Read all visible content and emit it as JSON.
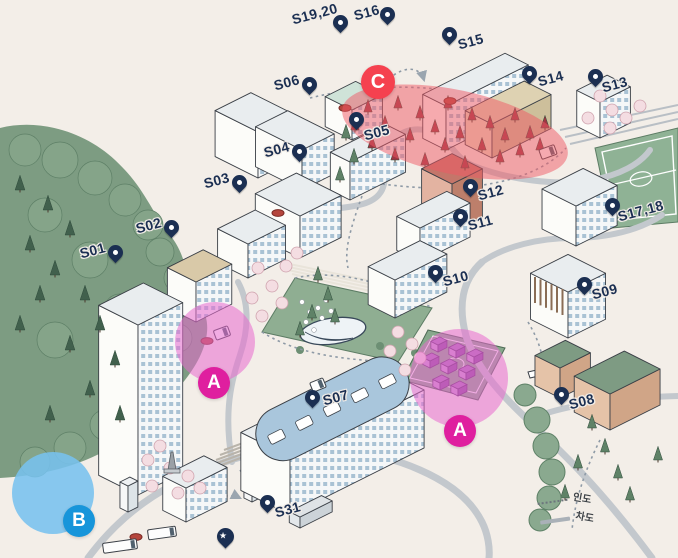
{
  "canvas": {
    "width": 678,
    "height": 558,
    "background": "#f3eee8"
  },
  "pins": {
    "color": "#1b2f52",
    "items": [
      {
        "id": "s01",
        "label": "S01",
        "tip": [
          116,
          263
        ],
        "text": [
          78,
          246
        ]
      },
      {
        "id": "s02",
        "label": "S02",
        "tip": [
          172,
          238
        ],
        "text": [
          134,
          221
        ]
      },
      {
        "id": "s03",
        "label": "S03",
        "tip": [
          240,
          193
        ],
        "text": [
          202,
          176
        ]
      },
      {
        "id": "s04",
        "label": "S04",
        "tip": [
          300,
          162
        ],
        "text": [
          262,
          145
        ]
      },
      {
        "id": "s05",
        "label": "S05",
        "tip": [
          357,
          130
        ],
        "text": [
          362,
          128
        ]
      },
      {
        "id": "s06",
        "label": "S06",
        "tip": [
          310,
          95
        ],
        "text": [
          272,
          78
        ]
      },
      {
        "id": "s07",
        "label": "S07",
        "tip": [
          313,
          408
        ],
        "text": [
          321,
          393
        ]
      },
      {
        "id": "s08",
        "label": "S08",
        "tip": [
          562,
          405
        ],
        "text": [
          567,
          397
        ]
      },
      {
        "id": "s09",
        "label": "S09",
        "tip": [
          585,
          295
        ],
        "text": [
          590,
          287
        ]
      },
      {
        "id": "s10",
        "label": "S10",
        "tip": [
          436,
          283
        ],
        "text": [
          441,
          274
        ]
      },
      {
        "id": "s11",
        "label": "S11",
        "tip": [
          461,
          227
        ],
        "text": [
          466,
          218
        ]
      },
      {
        "id": "s12",
        "label": "S12",
        "tip": [
          471,
          197
        ],
        "text": [
          476,
          188
        ]
      },
      {
        "id": "s13",
        "label": "S13",
        "tip": [
          596,
          87
        ],
        "text": [
          600,
          80
        ]
      },
      {
        "id": "s14",
        "label": "S14",
        "tip": [
          530,
          84
        ],
        "text": [
          536,
          74
        ]
      },
      {
        "id": "s15",
        "label": "S15",
        "tip": [
          450,
          45
        ],
        "text": [
          456,
          37
        ]
      },
      {
        "id": "s16",
        "label": "S16",
        "tip": [
          388,
          25
        ],
        "text": [
          352,
          8
        ]
      },
      {
        "id": "s17-18",
        "label": "S17,18",
        "tip": [
          613,
          216
        ],
        "text": [
          616,
          209
        ]
      },
      {
        "id": "s19-20",
        "label": "S19,20",
        "tip": [
          341,
          33
        ],
        "text": [
          290,
          12
        ]
      },
      {
        "id": "s31",
        "label": "S31",
        "tip": [
          268,
          513
        ],
        "text": [
          273,
          505
        ]
      }
    ],
    "star_pin": {
      "icon": "star-pin",
      "tip": [
        225,
        548
      ],
      "glyph": "★"
    }
  },
  "zones": {
    "highlight_pink": "rgba(232,106,205,0.55)",
    "highlight_blue": "rgba(120,194,238,0.88)",
    "highlight_red": "rgba(240,88,100,0.5)",
    "badge_pink": "#df1f9f",
    "badge_blue": "#1795da",
    "badge_red": "#f5414f",
    "items": [
      {
        "id": "zone-a-west",
        "label": "A",
        "shape": "circle",
        "cx": 215,
        "cy": 342,
        "r": 40,
        "color": "pink",
        "badge": {
          "cx": 214,
          "cy": 383,
          "r": 16
        }
      },
      {
        "id": "zone-a-east",
        "label": "A",
        "shape": "circle",
        "cx": 459,
        "cy": 378,
        "r": 49,
        "color": "pink",
        "badge": {
          "cx": 460,
          "cy": 431,
          "r": 16
        }
      },
      {
        "id": "zone-b",
        "label": "B",
        "shape": "circle",
        "cx": 53,
        "cy": 493,
        "r": 41,
        "color": "blue",
        "badge": {
          "cx": 79,
          "cy": 521,
          "r": 16
        }
      },
      {
        "id": "zone-c",
        "label": "C",
        "shape": "ellipse",
        "cx": 455,
        "cy": 132,
        "rx": 115,
        "ry": 42,
        "rotate": 12,
        "color": "red",
        "badge": {
          "cx": 378,
          "cy": 82,
          "r": 17
        }
      }
    ]
  },
  "legend": {
    "items": [
      {
        "id": "walkway",
        "label": "인도",
        "line": "dotted"
      },
      {
        "id": "roadway",
        "label": "차도",
        "line": "solid"
      }
    ],
    "pos": [
      536,
      492
    ]
  }
}
